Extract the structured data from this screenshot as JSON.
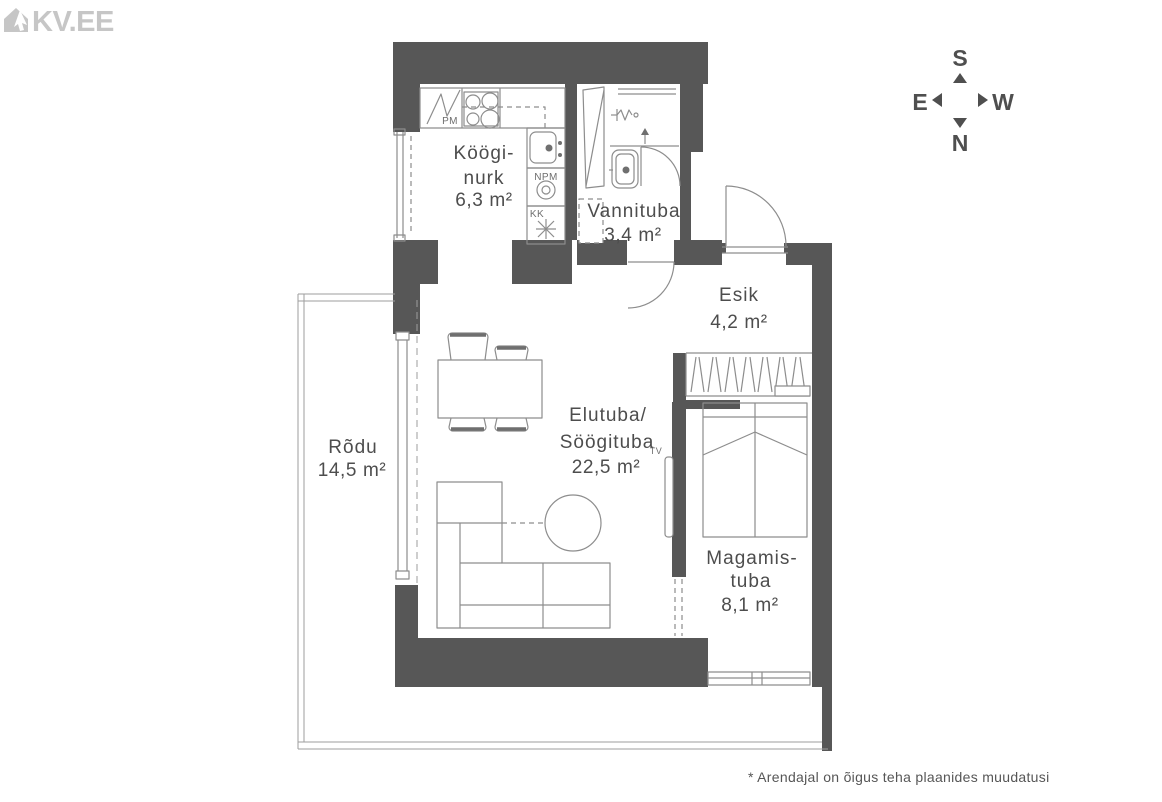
{
  "logo": {
    "text": "KV.EE"
  },
  "compass": {
    "south": "S",
    "north": "N",
    "east": "E",
    "west": "W"
  },
  "rooms": {
    "kitchen": {
      "line1": "Köögi-",
      "line2": "nurk",
      "area": "6,3 m²"
    },
    "bathroom": {
      "line1": "Vannituba",
      "area": "3,4 m²"
    },
    "hallway": {
      "line1": "Esik",
      "area": "4,2 m²"
    },
    "living_dining": {
      "line1": "Elutuba/",
      "line2": "Söögituba",
      "area": "22,5 m²"
    },
    "bedroom": {
      "line1": "Magamis-",
      "line2": "tuba",
      "area": "8,1 m²"
    },
    "balcony": {
      "line1": "Rõdu",
      "area": "14,5 m²"
    }
  },
  "appliance_labels": {
    "washing_machine": "PM",
    "dishwasher": "NPM",
    "fridge": "KK",
    "tv": "TV"
  },
  "disclaimer": "*  Arendajal on õigus teha plaanides muudatusi",
  "colors": {
    "wall": "#575757",
    "furniture_line": "#8d8d8d",
    "railing_line": "#9e9e9e",
    "label_text": "#4d4d4d",
    "logo_gray": "#c6c6c6",
    "compass": "#4f4f4f",
    "disclaimer_text": "#565656"
  }
}
